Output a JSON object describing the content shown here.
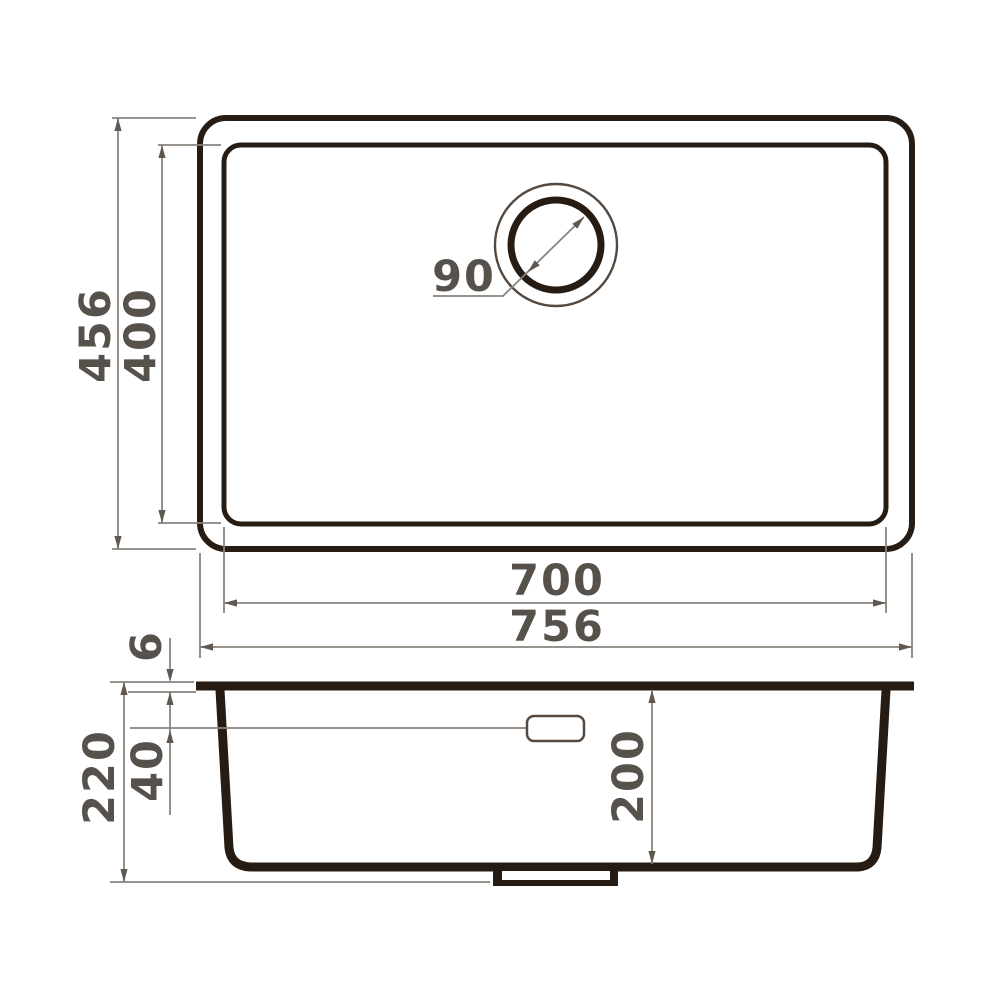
{
  "drawing": {
    "type": "sink-technical-drawing",
    "dimensions": {
      "outer_width": "756",
      "inner_width": "700",
      "outer_depth": "456",
      "inner_depth": "400",
      "drain_diameter": "90",
      "rim_thickness": "6",
      "overflow_offset": "40",
      "total_height": "220",
      "bowl_depth": "200"
    },
    "colors": {
      "background": "#ffffff",
      "outline": "#261c13",
      "thin_outline": "#55493f",
      "dimension_line": "#8a837b",
      "arrow": "#5f5850",
      "text": "#57514b"
    }
  }
}
